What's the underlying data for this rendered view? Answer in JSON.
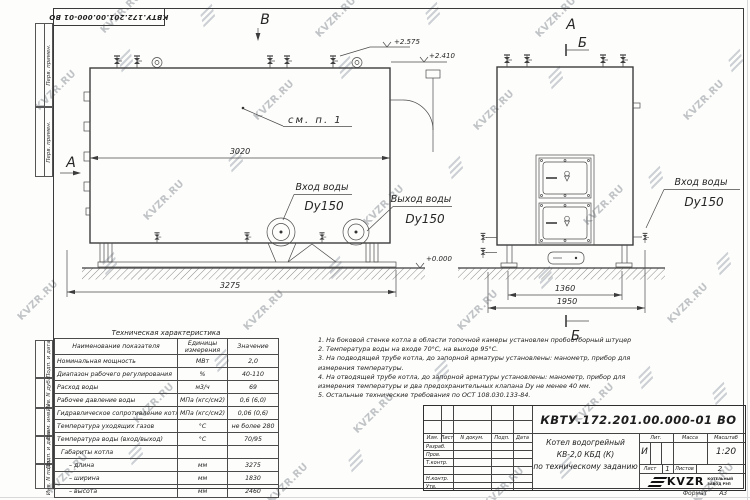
{
  "stamp": {
    "text": "КВТУ.172.201.00.000-01 ВО"
  },
  "margin": {
    "labels": [
      "Перв. примен.",
      "Перв. примен.",
      "Подп. и дата",
      "Инв. N дубл.",
      "Взам. инв. N",
      "Подп. и дата",
      "Инв. N подл."
    ]
  },
  "views": {
    "left": {
      "view_a": "А",
      "view_b": "В",
      "dim_inner": "3020",
      "dim_outer": "3275",
      "see_note": "см. п. 1",
      "inlet_label": "Вход воды",
      "inlet_dy": "Dy150",
      "outlet_label": "Выход воды",
      "outlet_dy": "Dy150",
      "level_top": "+2.575",
      "level_mid": "+2.410",
      "level_zero": "+0.000"
    },
    "right": {
      "view_a": "А",
      "section_top": "Б",
      "section_bottom": "Б",
      "dim_inner": "1360",
      "dim_outer": "1950",
      "inlet_label": "Вход воды",
      "inlet_dy": "Dy150"
    }
  },
  "tech_table": {
    "title": "Техническая характеристика",
    "headers": [
      "Наименование показателя",
      "Единицы измерения",
      "Значение"
    ],
    "rows": [
      {
        "name": "Номинальная мощность",
        "unit": "МВт",
        "value": "2,0"
      },
      {
        "name": "Диапазон рабочего регулирования",
        "unit": "%",
        "value": "40-110"
      },
      {
        "name": "Расход воды",
        "unit": "м3/ч",
        "value": "69"
      },
      {
        "name": "Рабочее давление воды",
        "unit": "МПа (кгс/см2)",
        "value": "0,6 (6,0)"
      },
      {
        "name": "Гидравлическое сопротивление котла",
        "unit": "МПа (кгс/см2)",
        "value": "0,06 (0,6)"
      },
      {
        "name": "Температура уходящих газов",
        "unit": "°С",
        "value": "не более 280"
      },
      {
        "name": "Температура воды (вход/выход)",
        "unit": "°С",
        "value": "70/95"
      },
      {
        "name": "Габариты котла",
        "unit": "",
        "value": ""
      },
      {
        "name": "– длина",
        "unit": "мм",
        "value": "3275"
      },
      {
        "name": "– ширина",
        "unit": "мм",
        "value": "1830"
      },
      {
        "name": "– высота",
        "unit": "мм",
        "value": "2460"
      }
    ]
  },
  "notes": [
    "1. На боковой стенке котла в области топочной камеры установлен пробоотборный штуцер",
    "2. Температура воды на входе 70°С, на выходе 95°С.",
    "3. На подводящей трубе котла, до запорной арматуры установлены: манометр, прибор для",
    "измерения температуры.",
    "4. На отводящей трубе котла, до запорной арматуры установлены: манометр, прибор для",
    "измерения температуры и два предохранительных клапана Dу не менее 40 мм.",
    "5. Остальные технические требования по ОСТ 108.030.133-84."
  ],
  "title_block": {
    "doc_number": "КВТУ.172.201.00.000-01 ВО",
    "product_line1": "Котел водогрейный",
    "product_line2": "КВ-2,0 КБД (К)",
    "product_line3": "по техническому заданию",
    "col_izm": "Изм.",
    "col_list": "Лист",
    "col_doc": "N докум.",
    "col_podp": "Подп.",
    "col_data": "Дата",
    "row_razrab": "Разраб.",
    "row_prov": "Пров.",
    "row_tkontr": "Т.контр.",
    "row_nkontr": "Н.контр.",
    "row_utv": "Утв.",
    "lit_label": "Лит.",
    "lit_value": "И",
    "mass_label": "Масса",
    "scale_label": "Масштаб",
    "scale_value": "1:20",
    "sheet_label": "Лист",
    "sheet_value": "1",
    "sheets_label": "Листов",
    "sheets_value": "2",
    "logo_text": "KVZR",
    "logo_sub1": "КОТЕЛЬНЫЙ",
    "logo_sub2": "ЗАВОД РЭП"
  },
  "format": {
    "label": "Формат",
    "value": "А3"
  },
  "watermark": {
    "text": "KVZR.RU"
  }
}
